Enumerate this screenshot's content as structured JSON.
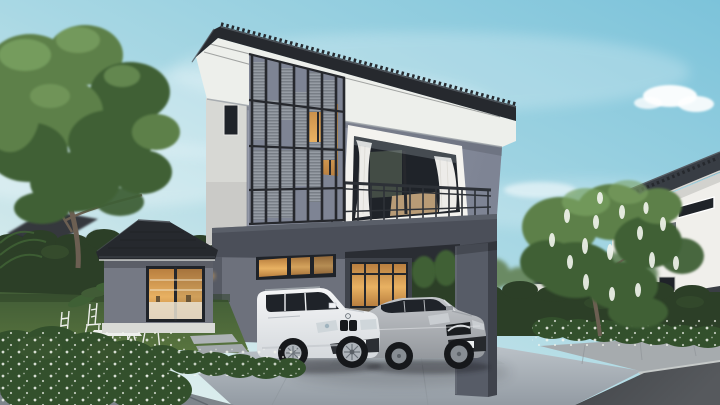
{
  "meta": {
    "description": "3D architectural rendering of a modern two-story detached house at dusk, black tiled hip roof, gray walls, lit interior, with a white SUV and a silver sedan parked in the double carport",
    "render_size": "720x405"
  },
  "scene": {
    "sky": {
      "condition": "clear light-blue sky with soft wispy clouds, one bright puffy cloud at upper right"
    },
    "main_house": {
      "stories": 2,
      "style": "modern contemporary with oriental black tiled roof",
      "features": [
        "black tiled hip roof with deep white eaves",
        "vertical slatted louver screen on upper-left facade",
        "second-floor balcony with black metal railing",
        "balcony sliding glass door with white curtains",
        "warm-lit transom window above the carport",
        "single-story side wing with lit kitchen window",
        "double carport framed by dark gray beam and column",
        "small wall lamp beside the wing"
      ]
    },
    "vehicles": [
      {
        "name": "white-suv",
        "description": "white luxury SUV with twin kidney grille parked under the carport"
      },
      {
        "name": "silver-sedan",
        "description": "silver sedan with wing grille parked beside the SUV"
      }
    ],
    "landscape": [
      "large leafy green tree on the left",
      "flowering tree with hanging white blossoms on the right",
      "trimmed dark green hedges",
      "lawn with white folding garden table and four chairs",
      "low shrubs dotted with small white flowers",
      "large paver walkway, light concrete driveway, curb and asphalt road"
    ],
    "neighborhood": [
      "gray two-story house with balcony on the far left",
      "small white pavilion behind the hedge",
      "white modern house with dark roof on the right"
    ]
  },
  "palette": {
    "sky_top": "#7cc3da",
    "sky_mid": "#a9d8e4",
    "sky_low": "#e6f1ef",
    "cloud": "#ffffff",
    "roof_tile": "#26292e",
    "roof_ridge": "#565c63",
    "soffit": "#edefeb",
    "fascia": "#9aa0a6",
    "wall_light": "#d7d8d4",
    "wall_light_shade": "#bfc0bc",
    "wall_front": "#979cab",
    "wall_front_dark": "#7e8494",
    "wall_first": "#6d717c",
    "band_dark": "#4b4f59",
    "column": "#575c67",
    "column_dark": "#3f434c",
    "louver_frame": "#26282d",
    "louver_panel": "#969ca4",
    "louver_line": "#70767e",
    "glass_dark": "#1f2329",
    "warm_light": "#e8b162",
    "warm_deep": "#b97f3f",
    "curtain": "#f4f3ef",
    "railing": "#2d3137",
    "interior_green": "#6f7f68",
    "bed_tan": "#c9a87e",
    "hedge": "#2c3f27",
    "hedge_light": "#3d5731",
    "tree_dark": "#3f6035",
    "tree_mid": "#5d8049",
    "tree_light": "#7ba263",
    "distant_tree": "#6b8a63",
    "lawn": "#5a763f",
    "lawn_dark": "#415c36",
    "shrub": "#33502c",
    "flower_white": "#f2f5ee",
    "paver": "#7e858b",
    "paver_joint": "#5d646b",
    "driveway": "#bcc3c9",
    "driveway_dark": "#939ba3",
    "sidewalk": "#a6abae",
    "curb": "#c6cac9",
    "road": "#56595d",
    "road_dark": "#43464a",
    "car_white": "#f5f6f7",
    "car_white_shade": "#d5d9dd",
    "car_silver": "#c3c6ca",
    "car_silver_shade": "#94989d",
    "tire": "#16181b",
    "rim_light": "#aeb4ba",
    "rim_dark": "#878d93",
    "neighbor_wall": "#f0efeb",
    "neighbor_roof": "#383d44",
    "left_house_wall": "#909298",
    "left_house_roof": "#34383e",
    "trunk": "#6c5f52",
    "shadow": "#1c1f24"
  }
}
